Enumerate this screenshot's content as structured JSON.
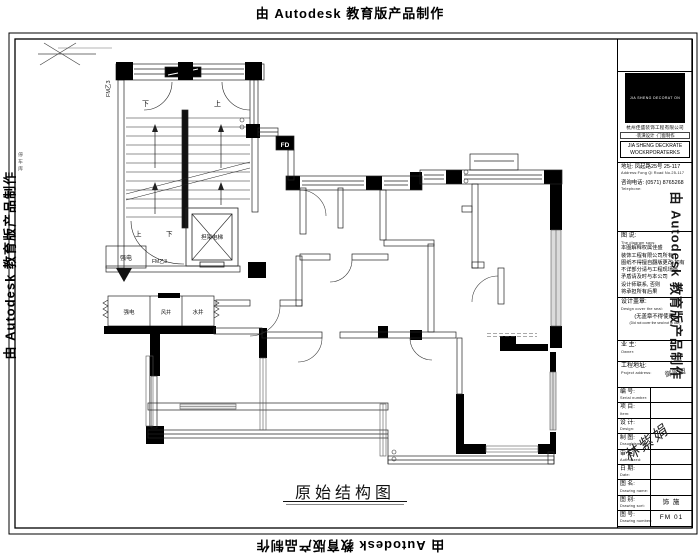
{
  "watermark": {
    "text": "由 Autodesk 教育版产品制作"
  },
  "margin_note": "停车库",
  "caption": "原始结构图",
  "plan": {
    "labels": {
      "fire_door_left": "FM乙3",
      "fire_door_bottom": "FM乙3",
      "down_top": "下",
      "up_top": "上",
      "up_bottom": "上",
      "down_bottom": "下",
      "elevator": "担架电梯",
      "electric_closet": "强电",
      "shaft_electric": "强电",
      "shaft_air": "风井",
      "shaft_water": "水井",
      "fd": "FD"
    }
  },
  "title_block": {
    "logo_caption": "JIA SHENG DECORAT ON",
    "company_cn": "杭州佳盛装饰工程有限公司",
    "services_line": "·装潢设计 ·门窗制作",
    "company_en_1": "JIA SHENG DECKRATE",
    "company_en_2": "WOCKRPORATERKS",
    "address_cn": "地址: 凤起路25号 25-117",
    "address_en": "Address:Fong Qi Road No.25-117",
    "phone_cn": "咨询电话: (0571) 8765268",
    "phone_en": "Telephone:",
    "notes_title": "图 说:",
    "notes_title_en": "The diagram says:",
    "notes_lines": [
      "本图解释权属佳盛",
      "装饰工程有限公司所有,",
      "图纸不得擅自翻版更改,如有",
      "不详部分请与工程现场核",
      "矛盾请及时与本公司",
      "设计师联系, 否则",
      "将承担所有后果"
    ],
    "seal_label": "设计盖章:",
    "seal_label_en": "Design cover the seal:",
    "seal_warning": "(无盖章不得使用)",
    "seal_warning_en": "(Did not cover the seal not to use)",
    "owner_label": "业 主:",
    "owner_label_en": "Owner:",
    "site_label": "工程地址:",
    "site_label_en": "Project address:",
    "site_value": "御翠园",
    "rows": [
      {
        "label": "编 号:",
        "en": "Serial number:",
        "value": ""
      },
      {
        "label": "项 目:",
        "en": "Item:",
        "value": ""
      },
      {
        "label": "设 计:",
        "en": "Design:",
        "value": ""
      },
      {
        "label": "制 图:",
        "en": "Draughtsman:",
        "value": ""
      },
      {
        "label": "审 定:",
        "en": "Authorized:",
        "value": ""
      },
      {
        "label": "日 期:",
        "en": "Date:",
        "value": ""
      },
      {
        "label": "图 名:",
        "en": "Drawing name:",
        "value": ""
      },
      {
        "label": "图 别:",
        "en": "Drawing sort:",
        "value": "饰 施"
      },
      {
        "label": "图 号:",
        "en": "Drawing number:",
        "value": "FM 01"
      }
    ],
    "signature": "林紫娟"
  }
}
